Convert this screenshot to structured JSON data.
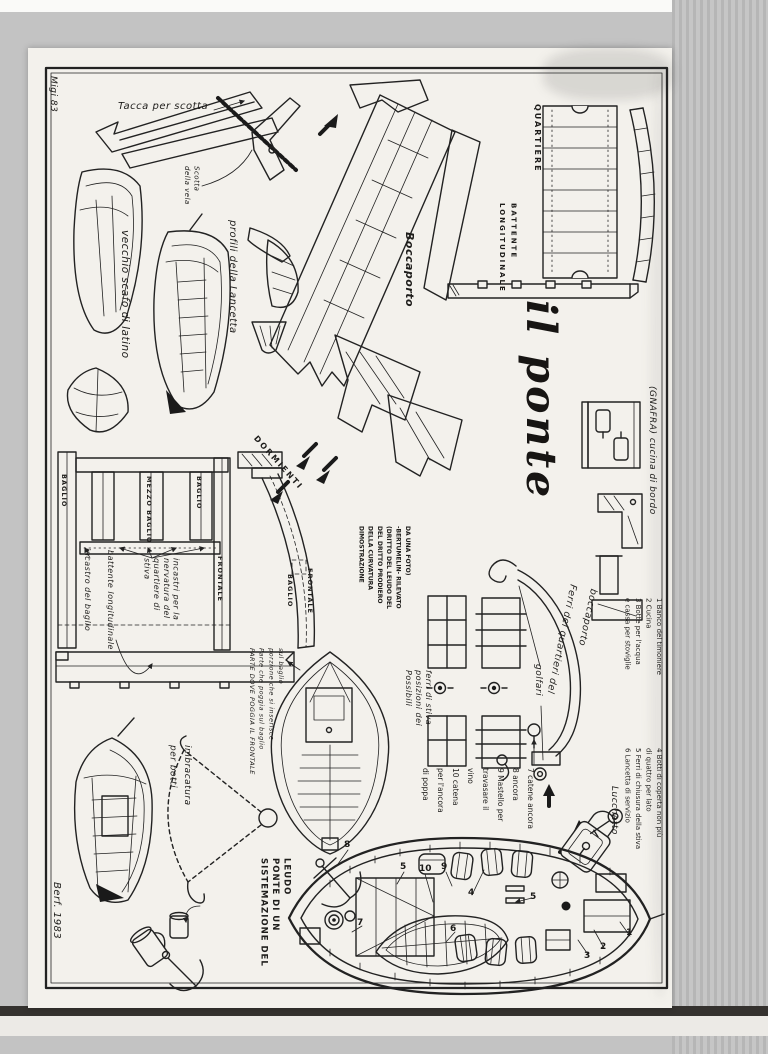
{
  "colors": {
    "paper": "#f3f1ec",
    "ink": "#222222",
    "scanner_gray": "#c3c3c3"
  },
  "page": {
    "artist_mark": "Migi 83",
    "signature": "Berf. 1983",
    "title": "il ponte"
  },
  "labels": {
    "tacca_per_scotta": "Tacca per scotta",
    "scotta_vela_1": "Scotta",
    "scotta_vela_2": "della vela",
    "vecchio_scafo": "vecchio scafo di latino",
    "profili_lancetta": "profili della Lancetta",
    "quartiere": "QUARTIERE",
    "battente_caps_1": "BATTENTE",
    "battente_caps_2": "LONGITUDINALE",
    "boccaporto": "Boccaporto",
    "gnafra": "(GNAFRA)  cucina di bordo",
    "dormienti": "DORMIENTI",
    "baglio_left": "BAGLIO",
    "mezzo_baglio": "MEZZO BAGLIO",
    "baglio_right": "BAGLIO",
    "frontale_section": "FRONTALE",
    "baglio_curve": "BAGLIO",
    "frontale_curve": "FRONTALE",
    "incastro_del_baglio": "incastro del baglio",
    "battente_longitudinale_hand": "battente longitudinale",
    "incastri_1": "incastri per la",
    "incastri_2": "nervatura del",
    "incastri_3": "quartiere di",
    "incastri_4": "stiva",
    "dimostrazione_1": "DIMOSTRAZIONE",
    "dimostrazione_2": "DELLA CURVATURA",
    "dimostrazione_3": "DEL DRITTO PRODIERO",
    "dimostrazione_4": "(DRITTO DEL LEUDO DEL",
    "dimostrazione_5": "-BERTUMELIN- RILEVATO",
    "dimostrazione_6": "DA UNA FOTO)",
    "ferri_quartieri_1": "Ferri dei quartieri del",
    "ferri_quartieri_2": "boccaporto",
    "golfari": "golfari",
    "possibili_1": "Possibili",
    "possibili_2": "posizioni dei",
    "possibili_3": "ferri di stiva",
    "parte_1": "PARTE DOVE POGGIA IL FRONTALE",
    "parte_2": "Parte che poggia sul baglio",
    "parte_3": "porzione che si inserisce",
    "parte_4": "sul baglio",
    "imbracatura_1": "imbracatura",
    "imbracatura_2": "per botti",
    "sistemazione_1": "SISTEMAZIONE DEL",
    "sistemazione_2": "PONTE DI UN",
    "sistemazione_3": "LEUDO",
    "lucchetto": "Lucchetto"
  },
  "legend": {
    "items_1_3": [
      "1 Banco del timoniere",
      "2 Cucina",
      "3 Botte per l'acqua",
      "e cassa per stoviglie"
    ],
    "items_4_6": [
      "4 Botti di coperta non più",
      "di quattro per lato",
      "5 Ferri di chiusura della stiva",
      "6 Lancetta di servizio"
    ],
    "items_7_10": [
      "7 catene ancora",
      "8 ancora",
      "9 Mastello per",
      "travasare il",
      "vino",
      "10 catena",
      "per l'ancora",
      "di poppa"
    ]
  },
  "plan_callouts": [
    "8",
    "5",
    "10",
    "9",
    "4",
    "7",
    "6",
    "5",
    "2",
    "3",
    "1"
  ]
}
